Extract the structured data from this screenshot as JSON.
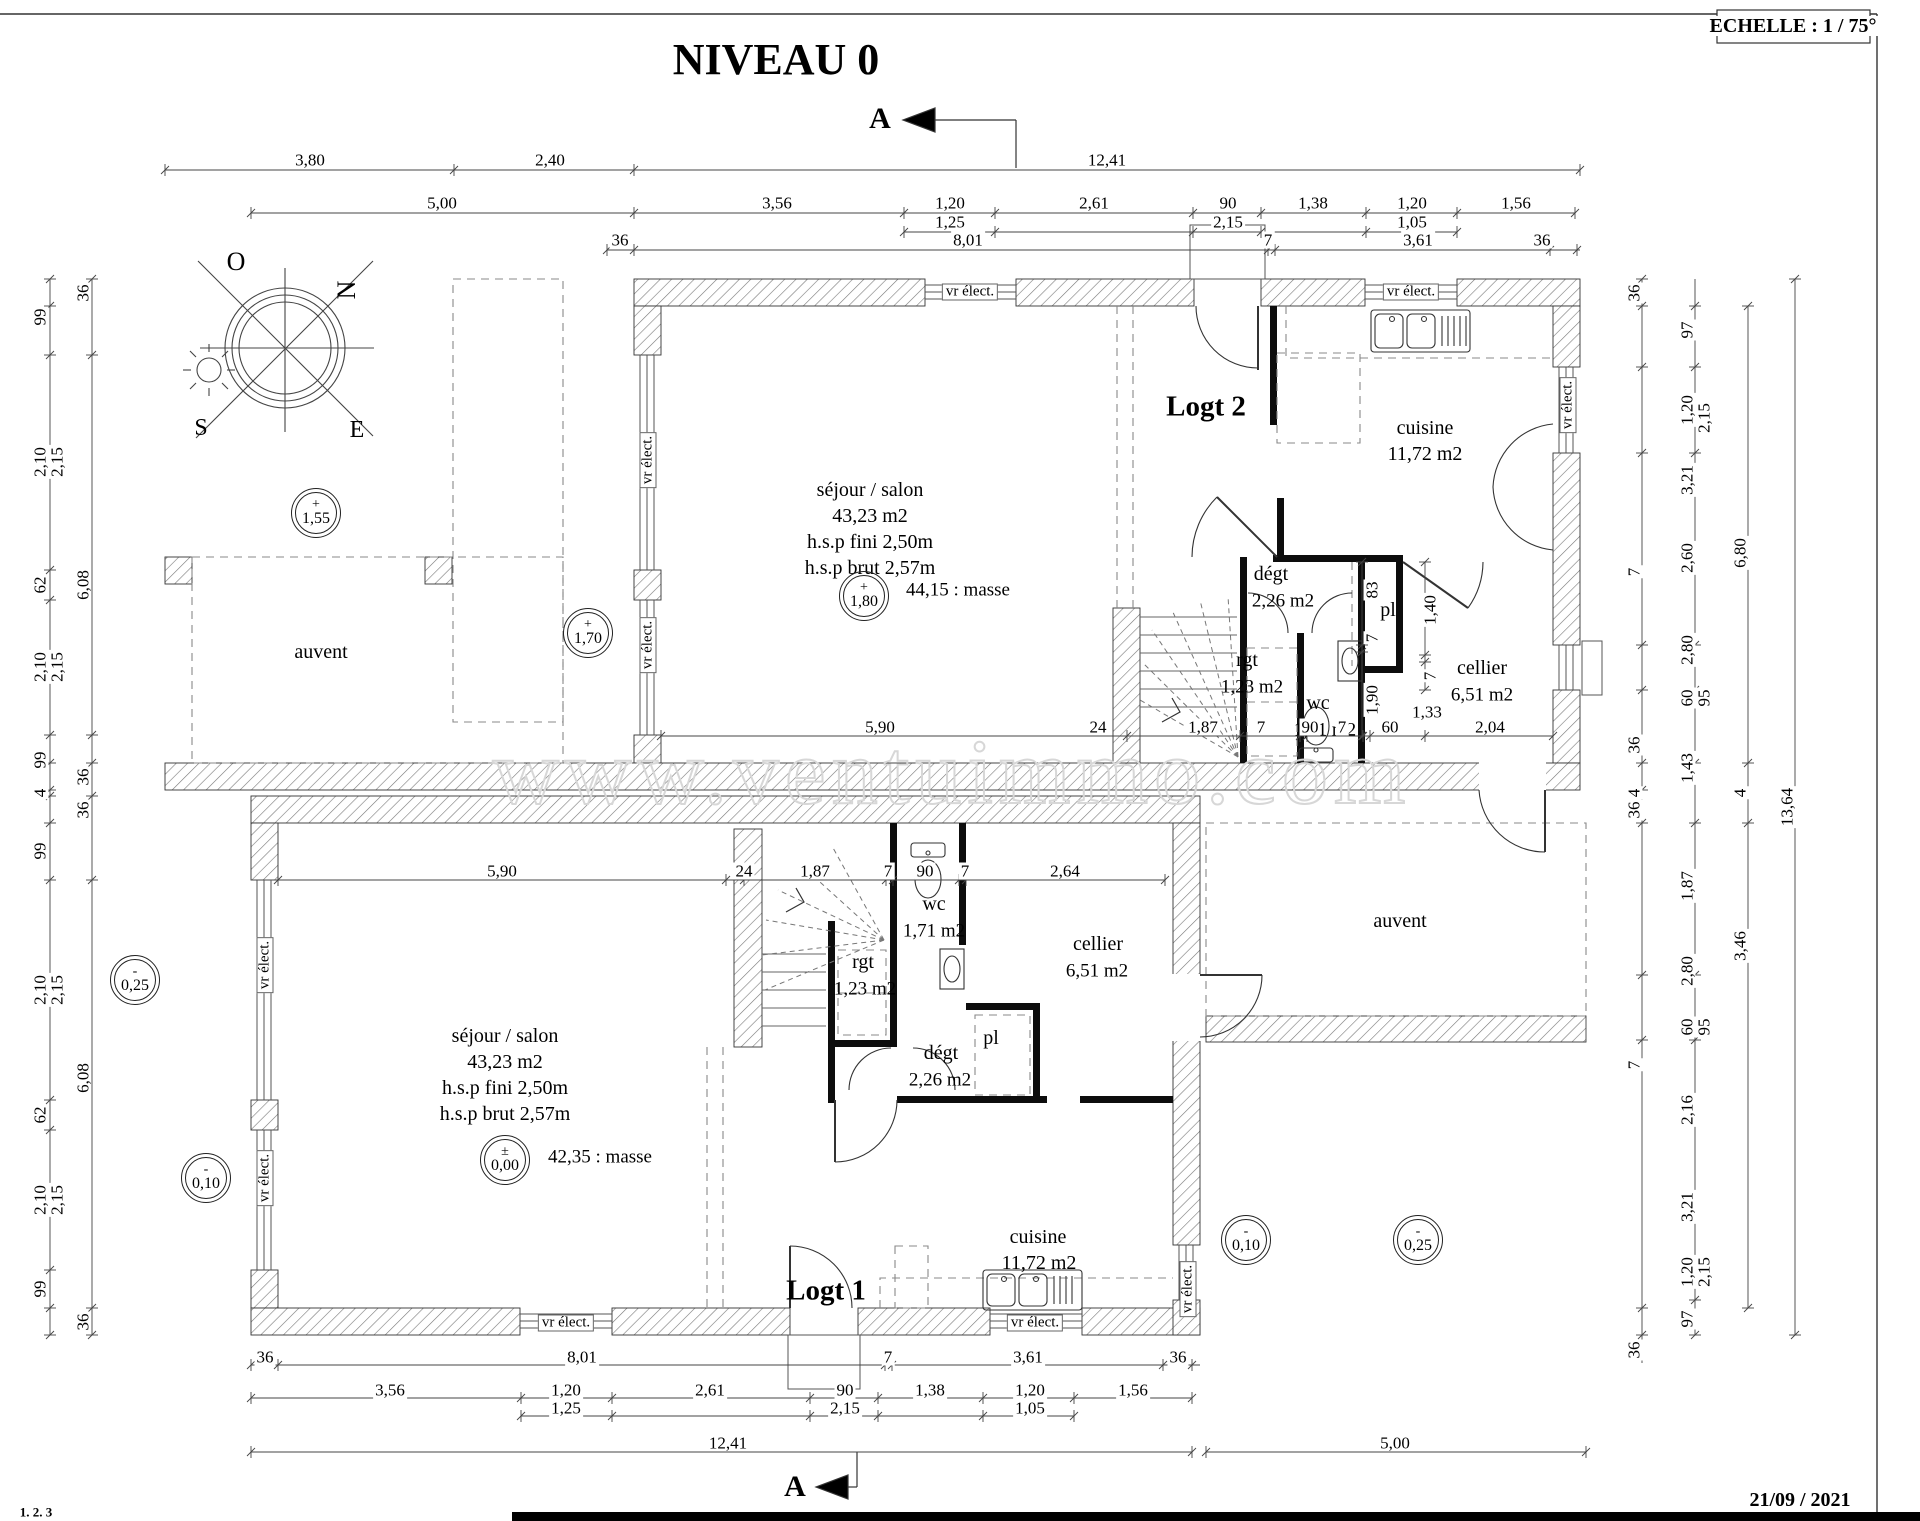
{
  "watermark": {
    "t": "www.ventuimmo.com"
  },
  "header": [
    {
      "t": "NIVEAU 0",
      "x": 776,
      "y": 60,
      "s": 44,
      "w": 1,
      "n": "page-title"
    },
    {
      "t": "ECHELLE : 1 / 75°",
      "x": 1793,
      "y": 26,
      "s": 20,
      "w": 1,
      "n": "scale-note"
    },
    {
      "t": "A",
      "x": 880,
      "y": 119,
      "s": 30,
      "w": 1,
      "n": "section-marker-top"
    },
    {
      "t": "A",
      "x": 795,
      "y": 1487,
      "s": 30,
      "w": 1,
      "n": "section-marker-bottom"
    },
    {
      "t": "21/09 / 2021",
      "x": 1800,
      "y": 1500,
      "s": 20,
      "w": 1,
      "n": "date-stamp"
    },
    {
      "t": "1. 2. 3",
      "x": 36,
      "y": 1512,
      "s": 13,
      "n": "corner-note"
    }
  ],
  "compass": [
    {
      "t": "O",
      "x": 236,
      "y": 262,
      "s": 26
    },
    {
      "t": "N",
      "x": 347,
      "y": 290,
      "s": 26,
      "r": 1
    },
    {
      "t": "S",
      "x": 201,
      "y": 428,
      "s": 24
    },
    {
      "t": "E",
      "x": 357,
      "y": 430,
      "s": 24
    }
  ],
  "rooms": [
    {
      "t": "Logt 2",
      "x": 1206,
      "y": 407,
      "s": 29,
      "w": 1
    },
    {
      "t": "séjour / salon",
      "x": 870,
      "y": 490
    },
    {
      "t": "43,23 m2",
      "x": 870,
      "y": 516
    },
    {
      "t": "h.s.p fini 2,50m",
      "x": 870,
      "y": 542
    },
    {
      "t": "h.s.p brut 2,57m",
      "x": 870,
      "y": 568
    },
    {
      "t": "44,15 : masse",
      "x": 958,
      "y": 590,
      "s": 19
    },
    {
      "t": "cuisine",
      "x": 1425,
      "y": 428
    },
    {
      "t": "11,72 m2",
      "x": 1425,
      "y": 454
    },
    {
      "t": "dégt",
      "x": 1271,
      "y": 574
    },
    {
      "t": "2,26 m2",
      "x": 1283,
      "y": 601,
      "s": 19
    },
    {
      "t": "rgt",
      "x": 1247,
      "y": 660
    },
    {
      "t": "1,23 m2",
      "x": 1252,
      "y": 687,
      "s": 19
    },
    {
      "t": "wc",
      "x": 1318,
      "y": 703
    },
    {
      "t": "1,71 m2",
      "x": 1325,
      "y": 730,
      "s": 19
    },
    {
      "t": "pl",
      "x": 1388,
      "y": 610
    },
    {
      "t": "cellier",
      "x": 1482,
      "y": 668
    },
    {
      "t": "6,51 m2",
      "x": 1482,
      "y": 695,
      "s": 19
    },
    {
      "t": "auvent",
      "x": 321,
      "y": 652
    },
    {
      "t": "Logt 1",
      "x": 826,
      "y": 1291,
      "s": 29,
      "w": 1
    },
    {
      "t": "séjour / salon",
      "x": 505,
      "y": 1036
    },
    {
      "t": "43,23 m2",
      "x": 505,
      "y": 1062
    },
    {
      "t": "h.s.p fini 2,50m",
      "x": 505,
      "y": 1088
    },
    {
      "t": "h.s.p brut 2,57m",
      "x": 505,
      "y": 1114
    },
    {
      "t": "42,35 : masse",
      "x": 600,
      "y": 1157,
      "s": 19
    },
    {
      "t": "cuisine",
      "x": 1038,
      "y": 1237
    },
    {
      "t": "11,72 m2",
      "x": 1039,
      "y": 1263
    },
    {
      "t": "dégt",
      "x": 941,
      "y": 1053
    },
    {
      "t": "2,26 m2",
      "x": 940,
      "y": 1080,
      "s": 19
    },
    {
      "t": "rgt",
      "x": 863,
      "y": 962
    },
    {
      "t": "1,23 m2",
      "x": 865,
      "y": 989,
      "s": 19
    },
    {
      "t": "wc",
      "x": 934,
      "y": 904
    },
    {
      "t": "1,71 m2",
      "x": 934,
      "y": 931,
      "s": 19
    },
    {
      "t": "pl",
      "x": 991,
      "y": 1038
    },
    {
      "t": "cellier",
      "x": 1098,
      "y": 944
    },
    {
      "t": "6,51 m2",
      "x": 1097,
      "y": 971,
      "s": 19
    },
    {
      "t": "auvent",
      "x": 1400,
      "y": 921
    }
  ],
  "window_labels": [
    {
      "t": "vr élect.",
      "x": 970,
      "y": 292
    },
    {
      "t": "vr élect.",
      "x": 1411,
      "y": 292
    },
    {
      "t": "vr élect.",
      "x": 648,
      "y": 460,
      "r": 1
    },
    {
      "t": "vr élect.",
      "x": 648,
      "y": 645,
      "r": 1
    },
    {
      "t": "vr élect.",
      "x": 1568,
      "y": 405,
      "r": 1
    },
    {
      "t": "vr élect.",
      "x": 265,
      "y": 965,
      "r": 1
    },
    {
      "t": "vr élect.",
      "x": 265,
      "y": 1178,
      "r": 1
    },
    {
      "t": "vr élect.",
      "x": 566,
      "y": 1323
    },
    {
      "t": "vr élect.",
      "x": 1035,
      "y": 1323
    },
    {
      "t": "vr élect.",
      "x": 1188,
      "y": 1289,
      "r": 1
    }
  ],
  "levels": [
    {
      "sign": "+",
      "value": "1,55",
      "x": 316,
      "y": 513
    },
    {
      "sign": "+",
      "value": "1,70",
      "x": 588,
      "y": 633
    },
    {
      "sign": "+",
      "value": "1,80",
      "x": 864,
      "y": 596
    },
    {
      "sign": "±",
      "value": "0,00",
      "x": 505,
      "y": 1160
    },
    {
      "sign": "-",
      "value": "0,25",
      "x": 135,
      "y": 980
    },
    {
      "sign": "-",
      "value": "0,10",
      "x": 206,
      "y": 1178
    },
    {
      "sign": "-",
      "value": "0,10",
      "x": 1246,
      "y": 1240
    },
    {
      "sign": "-",
      "value": "0,25",
      "x": 1418,
      "y": 1240
    }
  ],
  "dims_top": [
    {
      "t": "3,80",
      "x": 310,
      "y": 160
    },
    {
      "t": "2,40",
      "x": 550,
      "y": 160
    },
    {
      "t": "12,41",
      "x": 1107,
      "y": 160
    },
    {
      "t": "5,00",
      "x": 442,
      "y": 203
    },
    {
      "t": "3,56",
      "x": 777,
      "y": 203
    },
    {
      "t": "1,20",
      "x": 950,
      "y": 203
    },
    {
      "t": "2,61",
      "x": 1094,
      "y": 203
    },
    {
      "t": "90",
      "x": 1228,
      "y": 203
    },
    {
      "t": "1,38",
      "x": 1313,
      "y": 203
    },
    {
      "t": "1,20",
      "x": 1412,
      "y": 203
    },
    {
      "t": "1,56",
      "x": 1516,
      "y": 203
    },
    {
      "t": "1,25",
      "x": 950,
      "y": 222
    },
    {
      "t": "2,15",
      "x": 1228,
      "y": 222
    },
    {
      "t": "1,05",
      "x": 1412,
      "y": 222
    },
    {
      "t": "36",
      "x": 620,
      "y": 240
    },
    {
      "t": "8,01",
      "x": 968,
      "y": 240
    },
    {
      "t": "7",
      "x": 1268,
      "y": 240
    },
    {
      "t": "3,61",
      "x": 1418,
      "y": 240
    },
    {
      "t": "36",
      "x": 1542,
      "y": 240
    }
  ],
  "dims_bottom": [
    {
      "t": "36",
      "x": 265,
      "y": 1357
    },
    {
      "t": "8,01",
      "x": 582,
      "y": 1357
    },
    {
      "t": "7",
      "x": 888,
      "y": 1357
    },
    {
      "t": "3,61",
      "x": 1028,
      "y": 1357
    },
    {
      "t": "36",
      "x": 1178,
      "y": 1357
    },
    {
      "t": "3,56",
      "x": 390,
      "y": 1390
    },
    {
      "t": "1,20",
      "x": 566,
      "y": 1390
    },
    {
      "t": "2,61",
      "x": 710,
      "y": 1390
    },
    {
      "t": "90",
      "x": 845,
      "y": 1390
    },
    {
      "t": "1,38",
      "x": 930,
      "y": 1390
    },
    {
      "t": "1,20",
      "x": 1030,
      "y": 1390
    },
    {
      "t": "1,56",
      "x": 1133,
      "y": 1390
    },
    {
      "t": "1,25",
      "x": 566,
      "y": 1408
    },
    {
      "t": "2,15",
      "x": 845,
      "y": 1408
    },
    {
      "t": "1,05",
      "x": 1030,
      "y": 1408
    },
    {
      "t": "12,41",
      "x": 728,
      "y": 1443
    },
    {
      "t": "5,00",
      "x": 1395,
      "y": 1443
    }
  ],
  "dims_left": [
    {
      "t": "99",
      "x": 40,
      "y": 317,
      "r": 1
    },
    {
      "t": "36",
      "x": 83,
      "y": 293,
      "r": 1
    },
    {
      "t": "2,10",
      "x": 40,
      "y": 462,
      "r": 1
    },
    {
      "t": "2,15",
      "x": 57,
      "y": 462,
      "r": 1
    },
    {
      "t": "62",
      "x": 40,
      "y": 585,
      "r": 1
    },
    {
      "t": "6,08",
      "x": 83,
      "y": 585,
      "r": 1
    },
    {
      "t": "2,10",
      "x": 40,
      "y": 667,
      "r": 1
    },
    {
      "t": "2,15",
      "x": 57,
      "y": 667,
      "r": 1
    },
    {
      "t": "99",
      "x": 40,
      "y": 760,
      "r": 1
    },
    {
      "t": "36",
      "x": 83,
      "y": 777,
      "r": 1
    },
    {
      "t": "4",
      "x": 40,
      "y": 793,
      "r": 1
    },
    {
      "t": "99",
      "x": 40,
      "y": 851,
      "r": 1
    },
    {
      "t": "36",
      "x": 83,
      "y": 810,
      "r": 1
    },
    {
      "t": "2,10",
      "x": 40,
      "y": 990,
      "r": 1
    },
    {
      "t": "2,15",
      "x": 57,
      "y": 990,
      "r": 1
    },
    {
      "t": "62",
      "x": 40,
      "y": 1115,
      "r": 1
    },
    {
      "t": "6,08",
      "x": 83,
      "y": 1078,
      "r": 1
    },
    {
      "t": "2,10",
      "x": 40,
      "y": 1200,
      "r": 1
    },
    {
      "t": "2,15",
      "x": 57,
      "y": 1200,
      "r": 1
    },
    {
      "t": "99",
      "x": 40,
      "y": 1289,
      "r": 1
    },
    {
      "t": "36",
      "x": 83,
      "y": 1322,
      "r": 1
    }
  ],
  "dims_right": [
    {
      "t": "36",
      "x": 1634,
      "y": 293,
      "r": 1
    },
    {
      "t": "97",
      "x": 1687,
      "y": 330,
      "r": 1
    },
    {
      "t": "1,20",
      "x": 1687,
      "y": 410,
      "r": 1
    },
    {
      "t": "2,15",
      "x": 1704,
      "y": 418,
      "r": 1
    },
    {
      "t": "3,21",
      "x": 1687,
      "y": 480,
      "r": 1
    },
    {
      "t": "2,60",
      "x": 1687,
      "y": 558,
      "r": 1
    },
    {
      "t": "6,80",
      "x": 1740,
      "y": 553,
      "r": 1
    },
    {
      "t": "7",
      "x": 1634,
      "y": 572,
      "r": 1
    },
    {
      "t": "2,80",
      "x": 1687,
      "y": 650,
      "r": 1
    },
    {
      "t": "60",
      "x": 1687,
      "y": 698,
      "r": 1
    },
    {
      "t": "95",
      "x": 1704,
      "y": 698,
      "r": 1
    },
    {
      "t": "36",
      "x": 1634,
      "y": 745,
      "r": 1
    },
    {
      "t": "1,43",
      "x": 1687,
      "y": 768,
      "r": 1
    },
    {
      "t": "4",
      "x": 1634,
      "y": 793,
      "r": 1
    },
    {
      "t": "4",
      "x": 1740,
      "y": 793,
      "r": 1
    },
    {
      "t": "13,64",
      "x": 1787,
      "y": 807,
      "r": 1
    },
    {
      "t": "36",
      "x": 1634,
      "y": 810,
      "r": 1
    },
    {
      "t": "1,87",
      "x": 1687,
      "y": 886,
      "r": 1
    },
    {
      "t": "3,46",
      "x": 1740,
      "y": 946,
      "r": 1
    },
    {
      "t": "2,80",
      "x": 1687,
      "y": 971,
      "r": 1
    },
    {
      "t": "60",
      "x": 1687,
      "y": 1027,
      "r": 1
    },
    {
      "t": "95",
      "x": 1704,
      "y": 1027,
      "r": 1
    },
    {
      "t": "7",
      "x": 1634,
      "y": 1065,
      "r": 1
    },
    {
      "t": "2,16",
      "x": 1687,
      "y": 1110,
      "r": 1
    },
    {
      "t": "3,21",
      "x": 1687,
      "y": 1207,
      "r": 1
    },
    {
      "t": "1,20",
      "x": 1687,
      "y": 1272,
      "r": 1
    },
    {
      "t": "2,15",
      "x": 1704,
      "y": 1272,
      "r": 1
    },
    {
      "t": "97",
      "x": 1687,
      "y": 1319,
      "r": 1
    },
    {
      "t": "36",
      "x": 1634,
      "y": 1350,
      "r": 1
    }
  ],
  "dims_interior": [
    {
      "t": "5,90",
      "x": 880,
      "y": 727
    },
    {
      "t": "24",
      "x": 1098,
      "y": 727
    },
    {
      "t": "1,87",
      "x": 1203,
      "y": 727
    },
    {
      "t": "7",
      "x": 1261,
      "y": 727
    },
    {
      "t": "90",
      "x": 1310,
      "y": 727
    },
    {
      "t": "7",
      "x": 1342,
      "y": 727
    },
    {
      "t": "60",
      "x": 1390,
      "y": 727
    },
    {
      "t": "1,33",
      "x": 1427,
      "y": 712
    },
    {
      "t": "2,04",
      "x": 1490,
      "y": 727
    },
    {
      "t": "83",
      "x": 1372,
      "y": 590,
      "r": 1
    },
    {
      "t": "7",
      "x": 1372,
      "y": 638,
      "r": 1
    },
    {
      "t": "1,90",
      "x": 1372,
      "y": 700,
      "r": 1
    },
    {
      "t": "1,40",
      "x": 1430,
      "y": 610,
      "r": 1
    },
    {
      "t": "7",
      "x": 1430,
      "y": 676,
      "r": 1
    },
    {
      "t": "5,90",
      "x": 502,
      "y": 871
    },
    {
      "t": "24",
      "x": 744,
      "y": 871
    },
    {
      "t": "1,87",
      "x": 815,
      "y": 871
    },
    {
      "t": "7",
      "x": 888,
      "y": 871
    },
    {
      "t": "90",
      "x": 925,
      "y": 871
    },
    {
      "t": "7",
      "x": 965,
      "y": 871
    },
    {
      "t": "2,64",
      "x": 1065,
      "y": 871
    }
  ]
}
